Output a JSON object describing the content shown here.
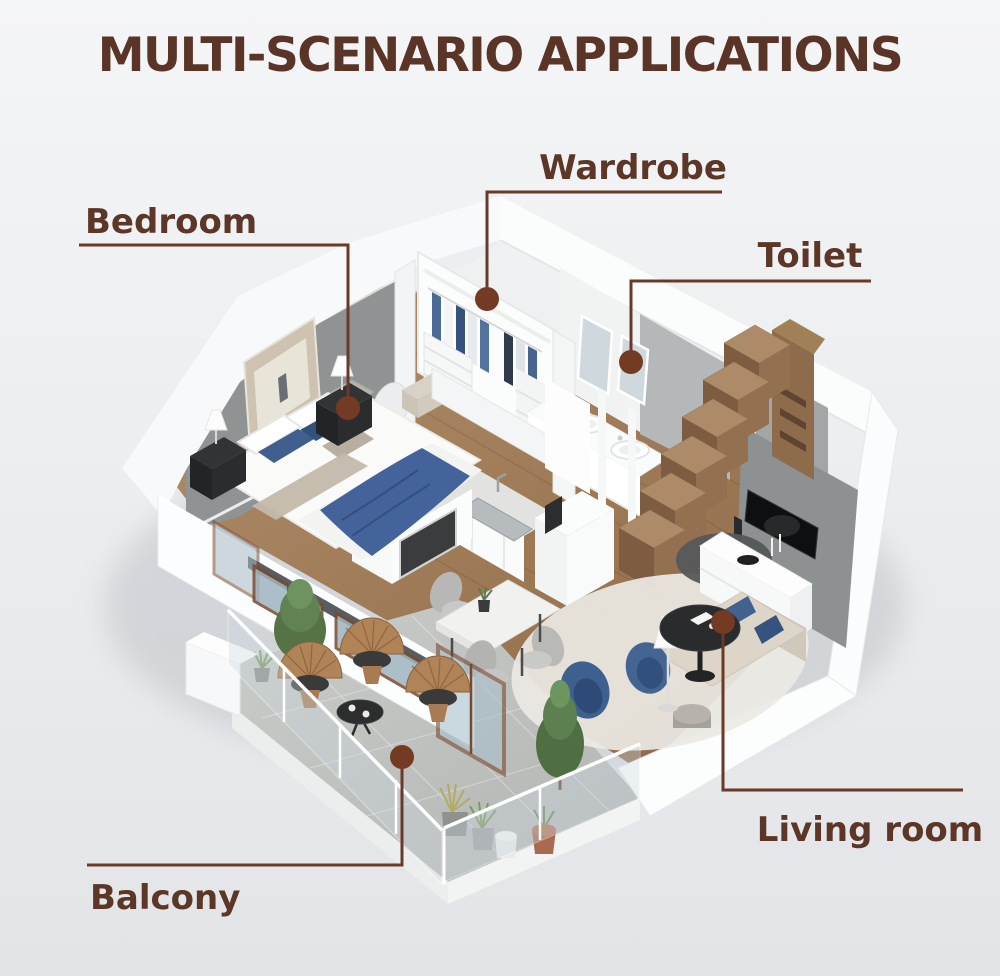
{
  "title": "MULTI-SCENARIO APPLICATIONS",
  "labels": {
    "bedroom": "Bedroom",
    "wardrobe": "Wardrobe",
    "toilet": "Toilet",
    "living_room": "Living room",
    "balcony": "Balcony"
  },
  "palette": {
    "title_color": "#5a3426",
    "label_color": "#5c3627",
    "callout_line": "#6b3927",
    "callout_dot": "#733b24",
    "background_top": "#f3f4f6",
    "background_bottom": "#e3e5e8",
    "wood_floor": "#a5815f",
    "wall_white": "#fbfcfd",
    "wall_gray": "#8f9394",
    "stair_wood": "#8d6b4b",
    "accent_blue": "#3f5f8e",
    "balcony_concrete": "#c0c2c0"
  }
}
